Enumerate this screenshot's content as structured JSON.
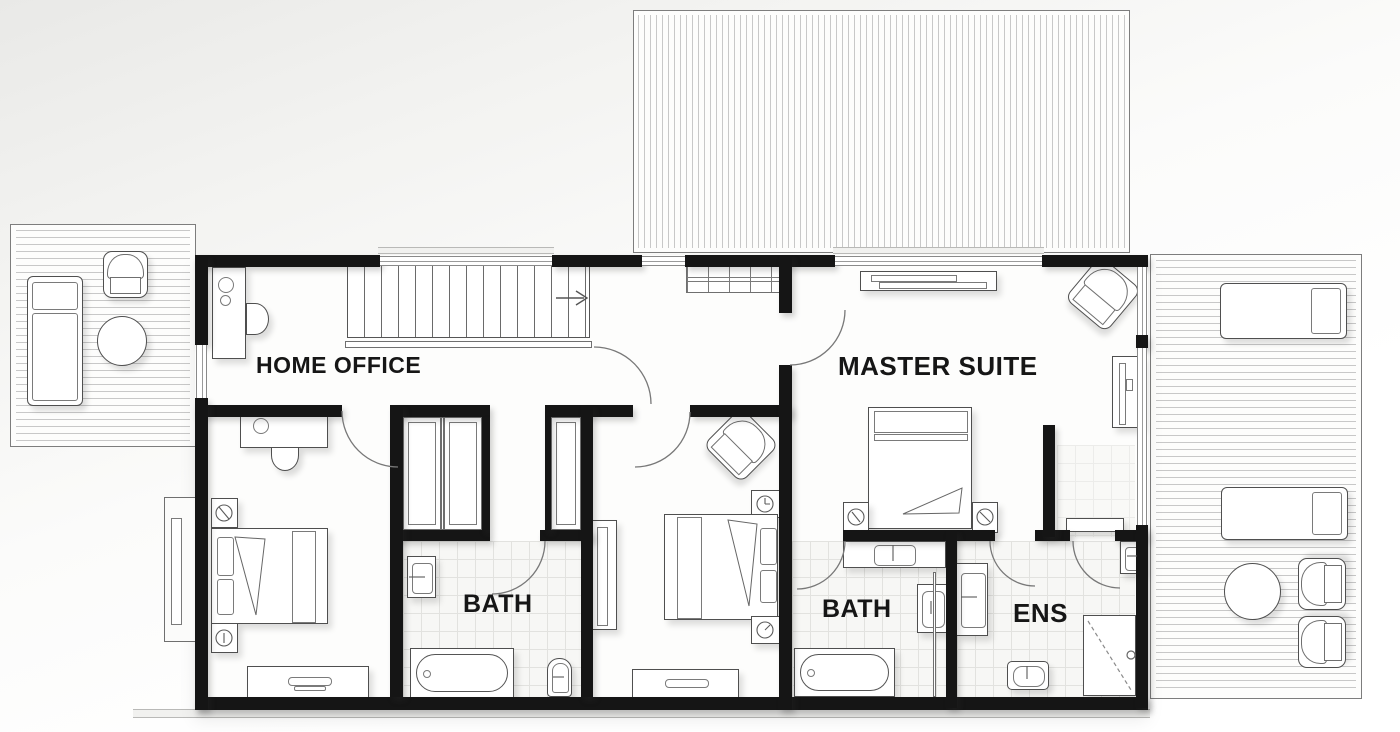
{
  "floorplan": {
    "rooms": {
      "home_office": {
        "label": "HOME OFFICE"
      },
      "master_suite": {
        "label": "MASTER SUITE"
      },
      "bath_1": {
        "label": "BATH"
      },
      "bath_2": {
        "label": "BATH"
      },
      "ensuite": {
        "label": "ENS"
      }
    },
    "colors": {
      "wall": "#151515",
      "furniture_line": "#4f4f4f",
      "hatch_line": "#c8c8c8",
      "tile_line": "#e2e2df",
      "label_text": "#161616"
    }
  }
}
